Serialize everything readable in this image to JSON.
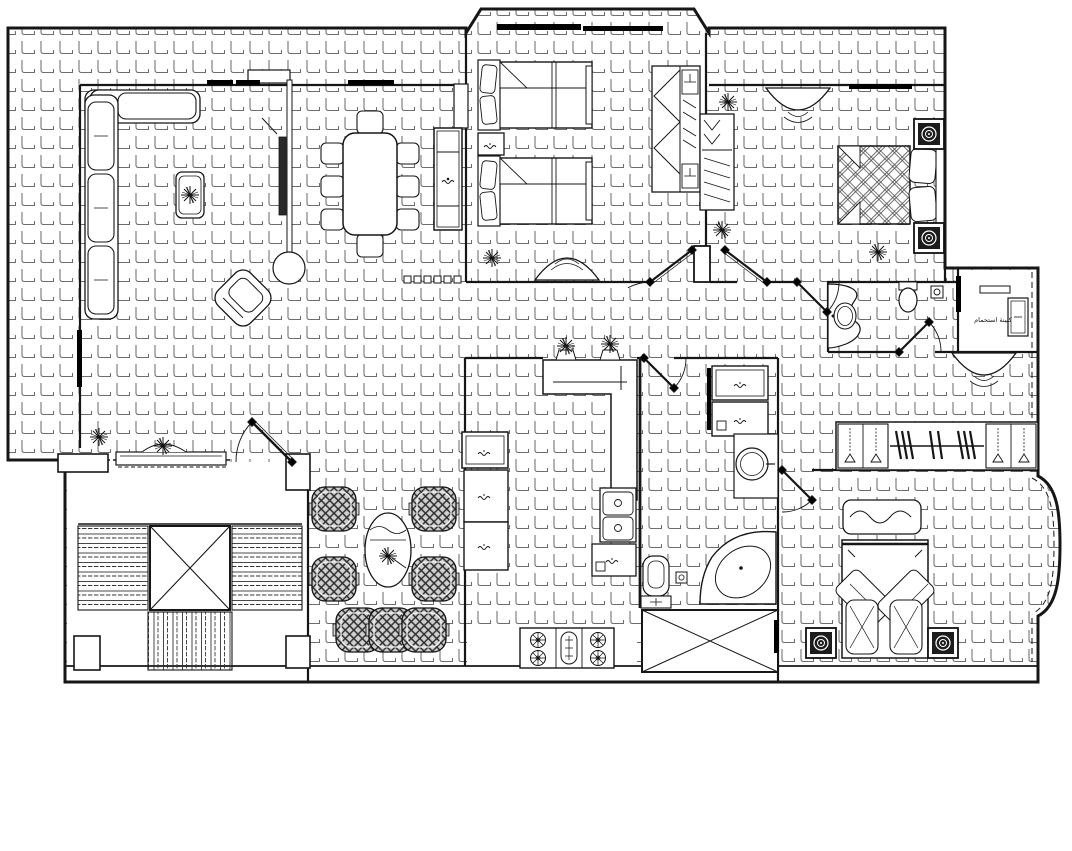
{
  "drawing": {
    "type": "apartment-floor-plan",
    "style": "cad-black-and-white-blueprint",
    "annotations": {
      "shower_cabin_label": "كبينة استحمام"
    },
    "colors": {
      "background": "#ffffff",
      "walls": "#161616",
      "tile_lines": "#6d6d6d",
      "window_bands": "#000000",
      "fixture_dark": "#1c1c1c",
      "pattern_fill": "#cfcfcf"
    },
    "symbols": [
      "l-shaped-sofa",
      "coffee-table-with-plant",
      "rotated-armchair",
      "tv-column-unit",
      "dining-table-eight-chairs",
      "sideboard-cabinet",
      "twin-bed",
      "nightstand",
      "open-wardrobe",
      "dressing-table-arc",
      "double-bed-lattice",
      "bedside-lamp-unit",
      "corner-bathtub",
      "toilet",
      "wash-basin",
      "vanity-counter",
      "floor-drain",
      "washing-machine-cabinet",
      "kitchen-bar-counter",
      "double-sink",
      "gas-stove",
      "refrigerator-cabinet",
      "pouf-armchair",
      "oval-side-table",
      "stair-flight",
      "elevator-shaft",
      "wardrobe-rail-with-hangers",
      "potted-plant",
      "door-swing",
      "window-band",
      "shower-cabin-room",
      "curved-bay-window"
    ]
  }
}
